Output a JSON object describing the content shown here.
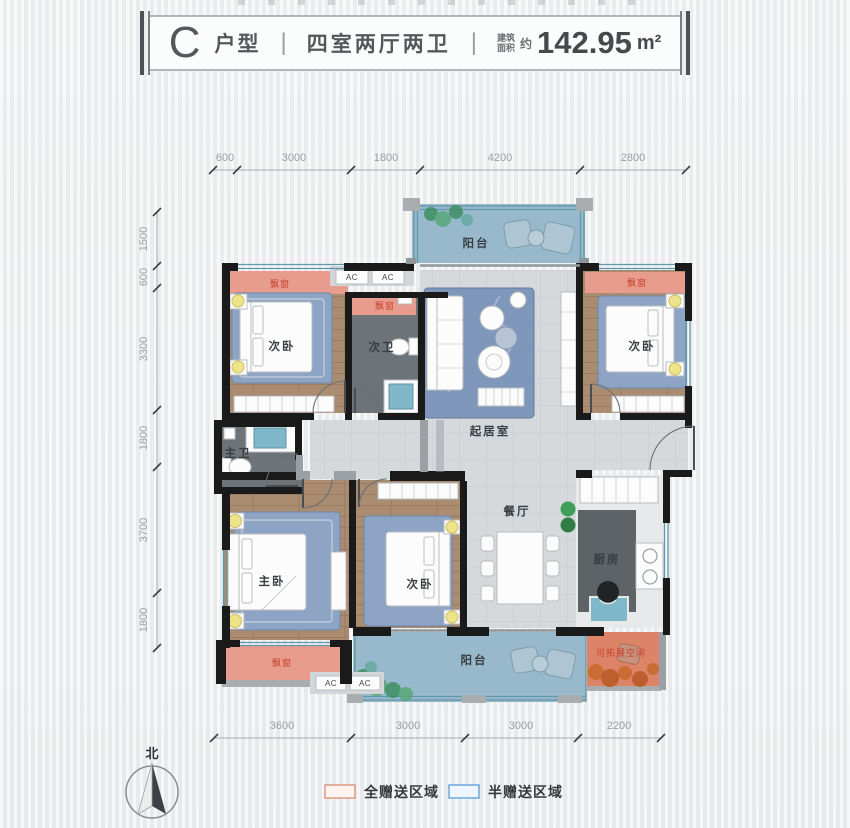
{
  "header": {
    "plan_letter": "C",
    "plan_word": "户型",
    "divider": "|",
    "layout_text": "四室两厅两卫",
    "area_prefix_line1": "建筑",
    "area_prefix_line2": "面积",
    "area_approx": "约",
    "area_value": "142.95",
    "area_unit": "m²"
  },
  "dimensions": {
    "top": [
      "600",
      "3000",
      "1800",
      "4200",
      "2800"
    ],
    "left": [
      "1500",
      "600",
      "3300",
      "1800",
      "3700",
      "1800"
    ],
    "bottom": [
      "3600",
      "3000",
      "3000",
      "2200"
    ]
  },
  "labels": {
    "balcony_top": "阳台",
    "bedroom_tl": "次卧",
    "bath_secondary": "次卫",
    "living": "起居室",
    "bedroom_tr": "次卧",
    "bath_master": "主卫",
    "bedroom_master": "主卧",
    "bedroom_mid": "次卧",
    "dining": "餐厅",
    "kitchen": "厨房",
    "balcony_bottom": "阳台",
    "expandable": "可拓展空间",
    "bay_window": "飘窗",
    "ac": "AC"
  },
  "legend": [
    {
      "label": "全赠送区域",
      "swatch_border": "#d98a72",
      "swatch_fill": "#fdf4f1"
    },
    {
      "label": "半赠送区域",
      "swatch_border": "#5b9bd5",
      "swatch_fill": "#eef5fc"
    }
  ],
  "compass": {
    "north": "北"
  },
  "colors": {
    "wall": "#1a1a1a",
    "wood_floor": "#aa8c71",
    "tile_floor": "#d5d9dc",
    "bath_floor": "#6d7479",
    "balcony_floor": "#98b9cb",
    "gift_area": "#e89c8d",
    "expand_area": "#dd8368",
    "bay_label_red": "#c6402c",
    "window_frame": "#5f98a8"
  }
}
